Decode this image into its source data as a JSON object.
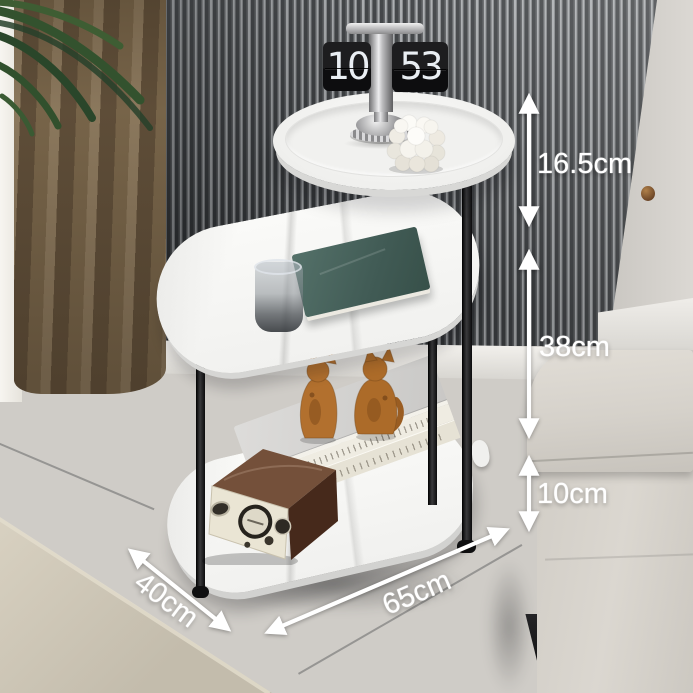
{
  "title": "Three-tier oval marble side table — product dimension photo",
  "dimension_labels": {
    "top_tier_gap": "16.5cm",
    "middle_tier_gap": "38cm",
    "bottom_clearance": "10cm",
    "table_length": "65cm",
    "table_depth": "40cm"
  },
  "flip_clock": {
    "hour": "10",
    "minute": "53"
  },
  "palette": {
    "dimension_text": "#ffffff",
    "marble_white": "#f6f6f4",
    "frame_black": "#181818",
    "slat_dark": "#2b2e31",
    "slat_light": "#a4a7aa",
    "curtain_brown": "#6f5e46",
    "sheer_white": "#f2efe9",
    "sofa_fabric": "#d7d3cc",
    "carpet_beige": "#cac3b3",
    "floor_gray": "#76777a",
    "radio_wood": "#5f3d2a",
    "radio_face": "#eae5d4",
    "cat_wood": "#b06f2d",
    "book_teal": "#46605c"
  },
  "props": [
    "flip-clock",
    "bubble-candle",
    "glass-cup",
    "teal-hardcover-book",
    "wooden-cat-figurines",
    "stacked-books",
    "vintage-wooden-radio"
  ],
  "environment": [
    "slat-accent-wall",
    "brown-curtain",
    "sheer-curtain",
    "plant-leaves",
    "gray-tile-floor",
    "beige-rug",
    "beige-sofa"
  ]
}
